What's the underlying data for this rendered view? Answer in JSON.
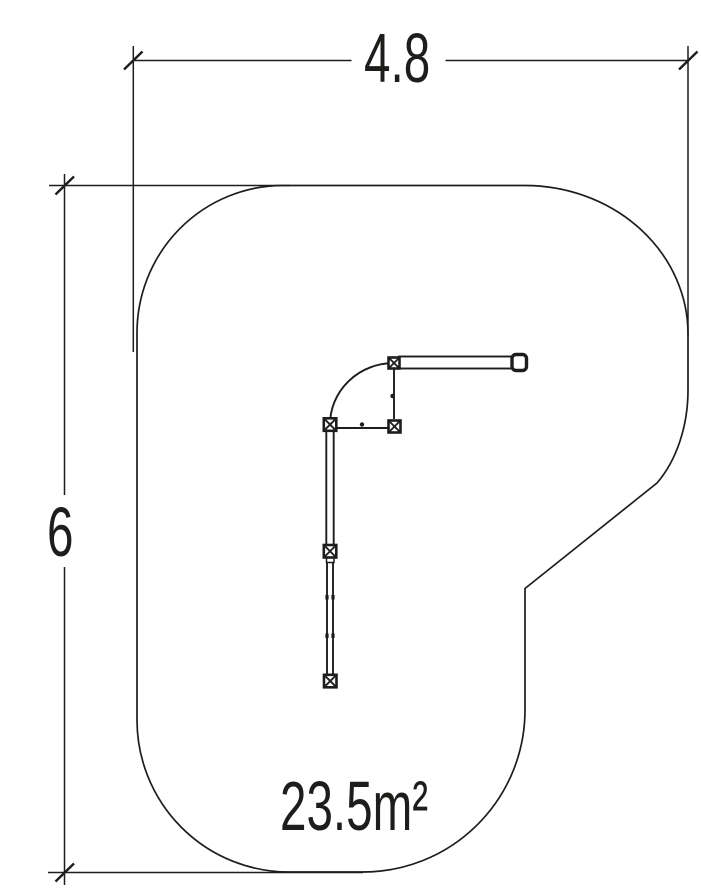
{
  "drawing": {
    "width_dimension": "4.8",
    "height_dimension": "6",
    "area_label": "23.5m²"
  },
  "colors": {
    "line": "#1d1d1b",
    "background": "#ffffff"
  }
}
